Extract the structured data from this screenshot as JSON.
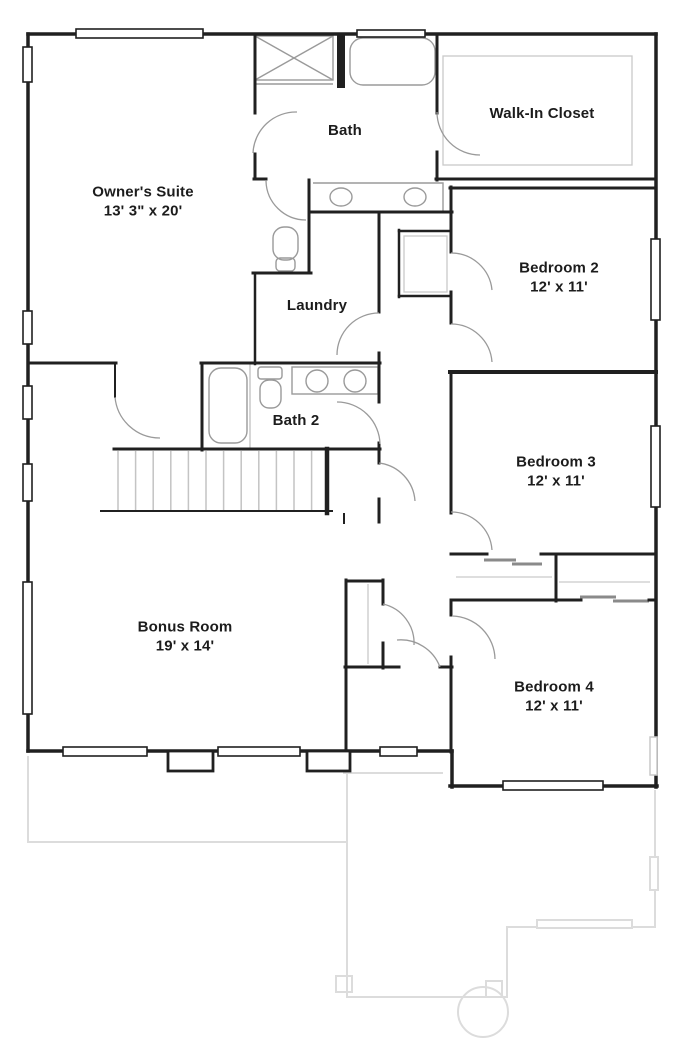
{
  "floorplan": {
    "title": "Second floor plan",
    "rooms": [
      {
        "name": "Owner's Suite",
        "dims": "13' 3\" x 20'"
      },
      {
        "name": "Bath",
        "dims": ""
      },
      {
        "name": "Walk-In Closet",
        "dims": ""
      },
      {
        "name": "Bedroom 2",
        "dims": "12' x 11'"
      },
      {
        "name": "Laundry",
        "dims": ""
      },
      {
        "name": "Bath 2",
        "dims": ""
      },
      {
        "name": "Bedroom 3",
        "dims": "12' x 11'"
      },
      {
        "name": "Bonus Room",
        "dims": "19' x 14'"
      },
      {
        "name": "Bedroom 4",
        "dims": "12' x 11'"
      }
    ],
    "colors": {
      "wall": "#202020",
      "fixture": "#9a9a9a",
      "shelf": "#c9c9c9",
      "faded_lower_level": "#dcdcdc",
      "text": "#1c1c1c",
      "background": "#ffffff"
    }
  }
}
